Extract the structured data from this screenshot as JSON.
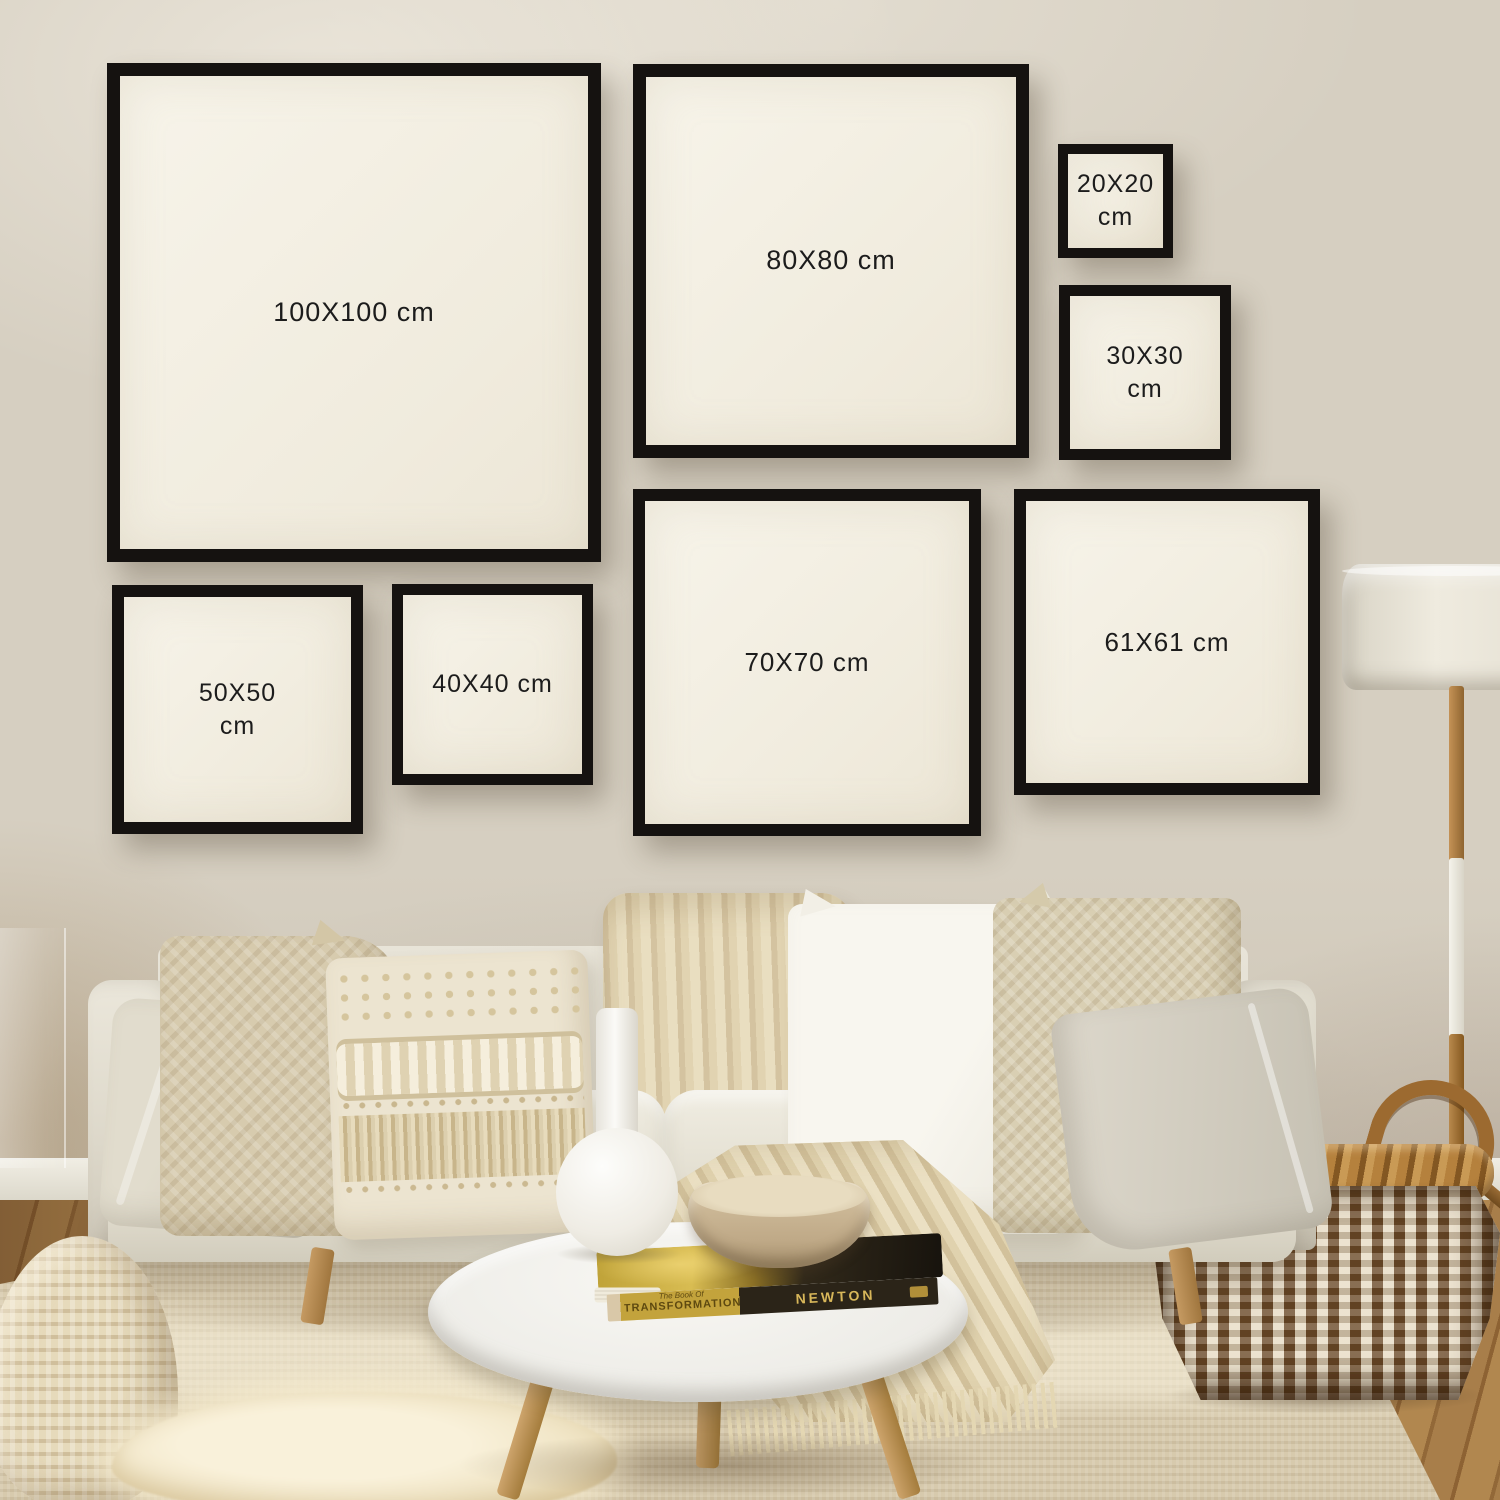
{
  "title": "Square black frame size comparison gallery wall",
  "frames": [
    {
      "id": "100x100",
      "line1": "100X100 cm",
      "line2": ""
    },
    {
      "id": "80x80",
      "line1": "80X80 cm",
      "line2": ""
    },
    {
      "id": "20x20",
      "line1": "20X20",
      "line2": "cm"
    },
    {
      "id": "30x30",
      "line1": "30X30",
      "line2": "cm"
    },
    {
      "id": "50x50",
      "line1": "50X50",
      "line2": "cm"
    },
    {
      "id": "40x40",
      "line1": "40X40 cm",
      "line2": ""
    },
    {
      "id": "70x70",
      "line1": "70X70 cm",
      "line2": ""
    },
    {
      "id": "61x61",
      "line1": "61X61 cm",
      "line2": ""
    }
  ],
  "scene": {
    "book": {
      "edge_text_small": "The Book Of",
      "edge_text_main": "TRANSFORMATION",
      "spine_text": "NEWTON"
    }
  },
  "colors": {
    "wall": "#d6cfc1",
    "frame_border": "#151210",
    "frame_mat": "#f4f0e4",
    "label_text": "#1c1c1c",
    "sofa": "#e3dfd2",
    "rug": "#d7caad",
    "wood_floor": "#9c7442",
    "basket_brown": "#6b4a28",
    "throw": "#dcceaa"
  }
}
